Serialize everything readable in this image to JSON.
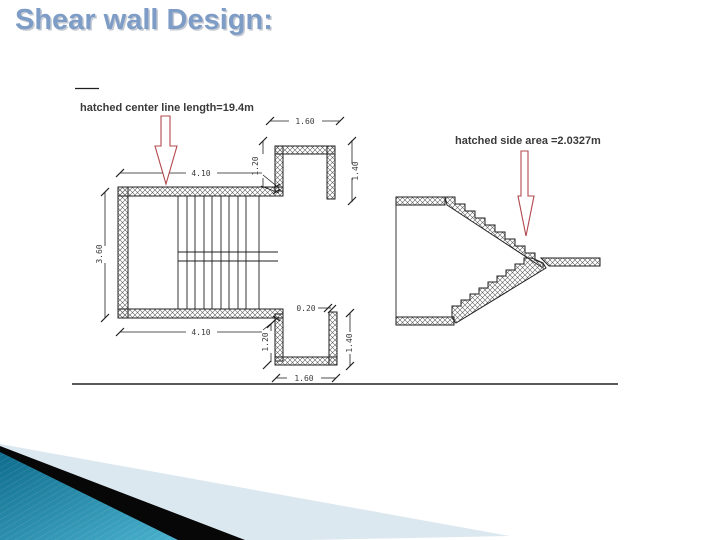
{
  "title": "Shear wall Design:",
  "annotations": {
    "center_line": "hatched center line length=19.4m",
    "side_area": "hatched side area =2.0327m"
  },
  "plan": {
    "dims": {
      "top_width": "4.10",
      "top_landing_width": "1.60",
      "top_landing_depth": "1.20",
      "top_landing_height": "1.40",
      "left_height": "3.60",
      "bottom_width": "4.10",
      "bottom_landing_depth": "1.20",
      "bottom_landing_height": "1.40",
      "wall_thickness": "0.20",
      "bottom_landing_width": "1.60"
    }
  },
  "colors": {
    "title": "#7d9cc6",
    "annotation": "#3a3a3a",
    "line": "#1f1f1f",
    "dim": "#3c3c3c",
    "red": "#b2484e",
    "teal_dark": "#0f6c8c",
    "teal_light": "#49b1cd",
    "pale": "#dce8f0",
    "black": "#070707"
  }
}
